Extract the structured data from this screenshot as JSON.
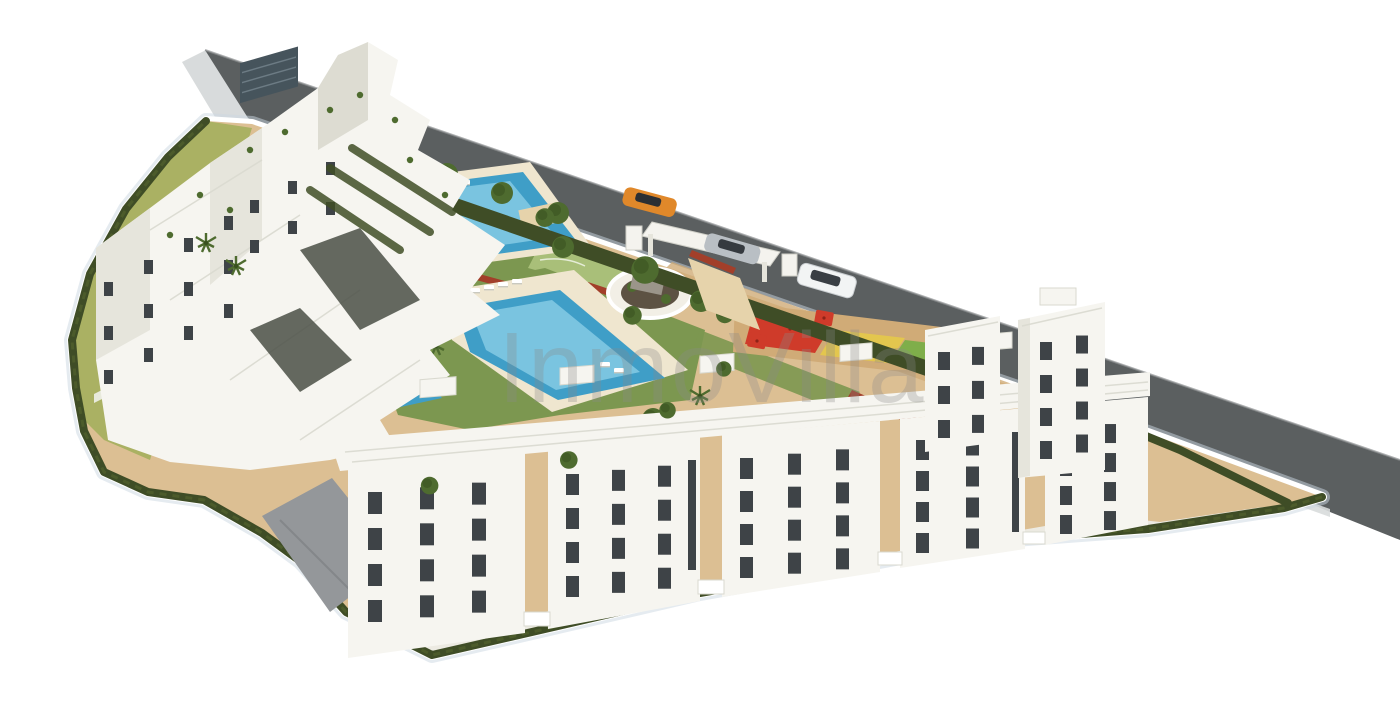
{
  "meta": {
    "description": "Aerial 3D architectural rendering of a white Mediterranean apartment complex with landscaped gardens, two swimming pools, a children's playground, terraced hillside stairs and a perimeter road with three cars"
  },
  "watermark": {
    "text": "InmoVilla",
    "opacity": 0.3
  },
  "colors": {
    "background": "#ffffff",
    "road": "#5b5f60",
    "road_edge": "#8d9091",
    "curb": "#d8dbdc",
    "hedge": "#3f4d26",
    "hedge_light": "#55652f",
    "tree": "#4e6b2f",
    "tree_dark": "#39511f",
    "lawn": "#7c9750",
    "lawn_light": "#a9bf79",
    "sand": "#dcbf93",
    "sand_dark": "#d0ab77",
    "paver": "#e6d3ab",
    "pool_deep": "#3f9ec7",
    "pool_light": "#8fd0e8",
    "deck": "#efe6cf",
    "building": "#f6f5f0",
    "building_shade": "#e6e5dc",
    "building_side": "#dddcd2",
    "window": "#3e4347",
    "rock": "#4a4f45",
    "step_light": "#e8eadc",
    "step_dark": "#b9c096",
    "hillside": "#aab163",
    "wall_dark": "#46545c",
    "ramp": "#94979a",
    "soil": "#5d5243",
    "stone": "#9b958a",
    "play_red": "#cf3b2a",
    "play_yellow": "#e3c64e",
    "play_green": "#7fae4a",
    "flower_red": "#a23f2a",
    "car_orange": "#e0882a",
    "car_silver": "#b9bfc4",
    "car_white": "#f2f4f4",
    "shadow": "#ccd8e2",
    "watermark": "#8a8a8a"
  },
  "scene": {
    "site": "residential complex site",
    "road": "perimeter road",
    "cars_visible": 3,
    "pools_visible": 2,
    "amenities": [
      "garden",
      "main swimming pool",
      "lap pool",
      "children playground",
      "entrance gate canopy",
      "hillside stairs"
    ],
    "buildings": {
      "left_cluster": "terraced apartment blocks",
      "bottom_row": "apartment building row",
      "right_block": "apartment towers with walled courtyard"
    }
  }
}
